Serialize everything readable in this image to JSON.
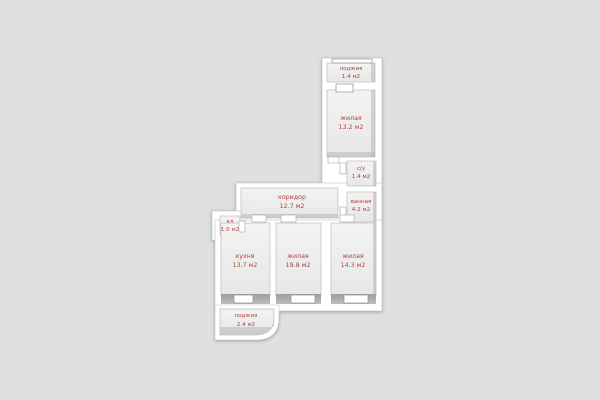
{
  "plan": {
    "rooms": [
      {
        "id": "loggia-top",
        "name": "лоджия",
        "area": "1.4 м2"
      },
      {
        "id": "living-top",
        "name": "жилая",
        "area": "13.2 м2"
      },
      {
        "id": "wc",
        "name": "с/у",
        "area": "1.4 м2"
      },
      {
        "id": "bathroom",
        "name": "ванная",
        "area": "4.2 м2"
      },
      {
        "id": "corridor",
        "name": "коридор",
        "area": "12.7 м2"
      },
      {
        "id": "closet",
        "name": "кл",
        "area": "1.0 м2"
      },
      {
        "id": "kitchen",
        "name": "кухня",
        "area": "13.7 м2"
      },
      {
        "id": "living-mid",
        "name": "жилая",
        "area": "19.8 м2"
      },
      {
        "id": "living-right",
        "name": "жилая",
        "area": "14.3 м2"
      },
      {
        "id": "loggia-bottom",
        "name": "лоджия",
        "area": "2.4 м2"
      }
    ],
    "colors": {
      "background": "#e0e0e0",
      "walls": "#ffffff",
      "floor_light": "#f3f3f3",
      "floor_dark": "#e7e7e7",
      "wall_shade": "#a9a9a9",
      "outline": "#c3c3c3",
      "label_text": "#a8453f"
    }
  }
}
